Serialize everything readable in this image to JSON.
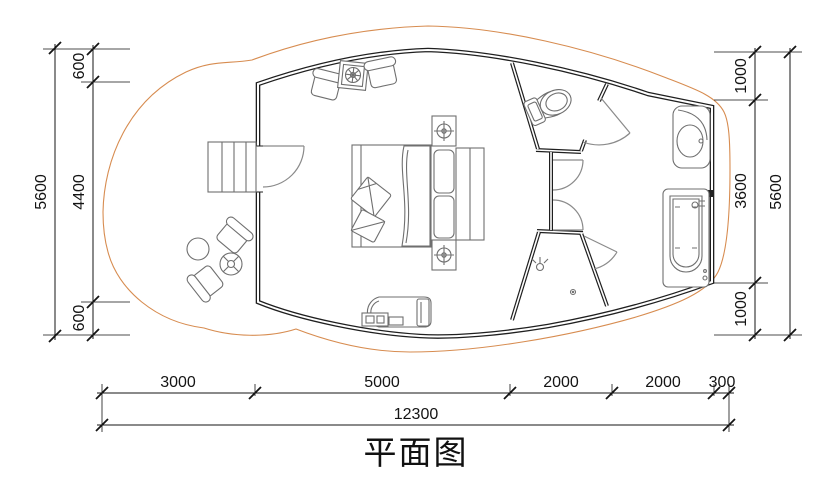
{
  "title": "平面图",
  "dimensions": {
    "left": {
      "total": "5600",
      "segments": [
        "600",
        "4400",
        "600"
      ]
    },
    "right": {
      "total": "5600",
      "segments": [
        "1000",
        "3600",
        "1000"
      ]
    },
    "bottom": {
      "total": "12300",
      "segments": [
        "3000",
        "5000",
        "2000",
        "2000",
        "300"
      ]
    }
  },
  "colors": {
    "deck_hatch": "#d78c50",
    "wall_line": "#1f1f1f",
    "furniture_line": "#6f6f6f",
    "door_line": "#8a8a8a",
    "dimension_line": "#141414"
  },
  "icons": [
    "stairs",
    "entry-door-swing",
    "armchair",
    "grill-table",
    "double-bed",
    "pillow",
    "nightstand-lamp",
    "bench-cushion",
    "wardrobe-hangers",
    "chaise-lounge",
    "toilet",
    "washbasin",
    "bathtub",
    "shower-head",
    "floor-drain",
    "round-table",
    "parasol-table",
    "interior-door-swing"
  ]
}
